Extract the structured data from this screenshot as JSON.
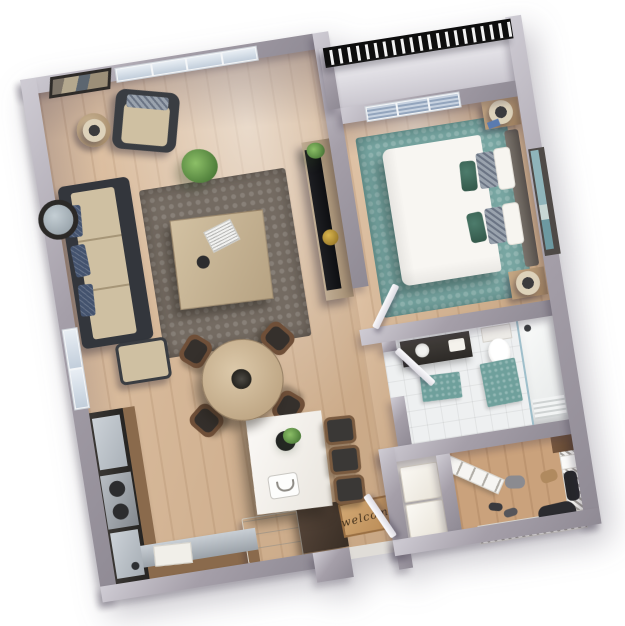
{
  "scene": {
    "type": "3d-floor-plan-render",
    "view": "top-down, plan rotated about -9 degrees, white background",
    "unit": "one-bedroom apartment"
  },
  "entry": {
    "mat_text": "welcome"
  },
  "palette": {
    "wall": "#8f8a94",
    "wall-mid": "#a59fa9",
    "wall-light": "#cfccd4",
    "wood-floor": "#d7b38e",
    "closet-floor": "#caa27c",
    "tile": "#eef0f1",
    "rug-living": "#746b62",
    "rug-bedroom": "#79a7a3",
    "sofa-dark": "#33363c",
    "sofa-cushion": "#cfc0a2",
    "pillow-navy": "#44536e",
    "wood-cabinet": "#8a6a4c",
    "counter-dark": "#322f2d",
    "island-white": "#f6f4f1",
    "table-wood": "#c9b496",
    "chair-brown": "#6f4f38",
    "bed-white": "#f8f6f2",
    "pillow-teal": "#3e6a5b",
    "headboard": "#6d6660",
    "nightstand": "#b6987a",
    "railing": "#141414",
    "mat": "#c99a66",
    "appliance-white": "#f3f0ea",
    "cabinet-darkwood": "#473a30",
    "art-teal": "#8fb4ba",
    "stainless": "#a7adb3"
  },
  "rooms": [
    {
      "name": "living-room",
      "floor": "wood"
    },
    {
      "name": "dining-area",
      "floor": "wood"
    },
    {
      "name": "kitchen",
      "floor": "wood"
    },
    {
      "name": "entry-hall",
      "floor": "wood"
    },
    {
      "name": "bedroom",
      "floor": "wood with teal rug"
    },
    {
      "name": "balcony",
      "floor": "concrete, black metal railing"
    },
    {
      "name": "bathroom",
      "floor": "white tile"
    },
    {
      "name": "laundry-closet",
      "floor": "tile"
    },
    {
      "name": "walk-in-closet",
      "floor": "wood"
    }
  ],
  "furniture": {
    "living": [
      "sectional-sofa",
      "ottoman",
      "armchair",
      "side-table-with-lamp",
      "wall-art",
      "round-wall-mirror",
      "potted-plant",
      "area-rug",
      "coffee-table-with-laptop",
      "tv-console",
      "flat-tv",
      "decor-bowl"
    ],
    "dining": [
      "round-dining-table",
      "dining-chair x4",
      "centerpiece-plant"
    ],
    "kitchen": [
      "l-shaped-counter",
      "gas-range",
      "sink",
      "refrigerator",
      "tall-cabinet",
      "kitchen-island",
      "bar-stool x3",
      "island-plant",
      "serving-tray"
    ],
    "bedroom": [
      "queen-bed",
      "teal-accent-pillows",
      "patterned-pillows",
      "headboard",
      "nightstand-with-lamp x2",
      "art-over-headboard",
      "teal-rug",
      "window-blinds"
    ],
    "bathroom": [
      "vanity-with-sink",
      "toilet",
      "glass-shower",
      "bath-mat x2"
    ],
    "laundry": [
      "washer",
      "dryer"
    ],
    "closet": [
      "wire-shelving x2",
      "hanging-clothes",
      "shoes",
      "storage-box",
      "leaning-shelf"
    ]
  }
}
